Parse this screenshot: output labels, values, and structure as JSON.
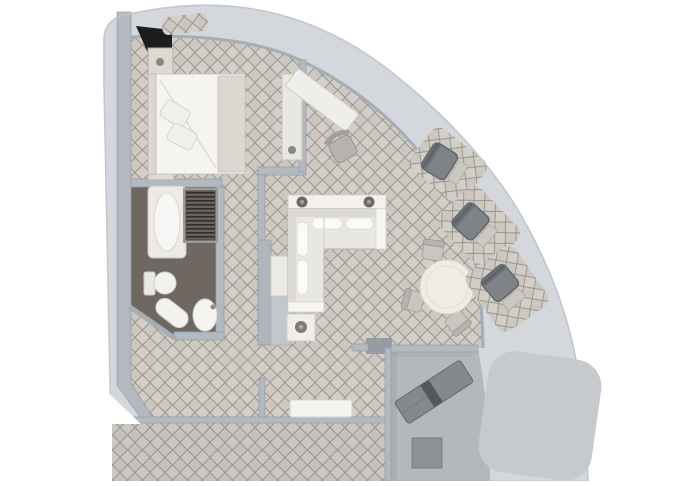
{
  "plan": {
    "title": "suite-floor-plan",
    "kind": "cruise-ship-suite-quarter-circle",
    "canvas": {
      "width": 680,
      "height": 486
    }
  },
  "colors": {
    "page_bg": "#ffffff",
    "hull_band": "#d4d8dd",
    "hull_edge": "#c2c7ce",
    "wall": "#b3b9c1",
    "wall_line": "#a2a9b2",
    "wall_light": "#c6cbd1",
    "carpet_base": "#ccc7c0",
    "carpet_line": "#8f8a82",
    "corridor_carpet_base": "#c5c2bd",
    "bathroom_floor": "#6f6761",
    "deck": "#b4b8bd",
    "deck_cutout": "#c6cacf",
    "furniture_white": "#f3f2ef",
    "furniture_shadow": "#cfccc6",
    "outdoor_dark": "#7f8388",
    "outdoor_darker": "#54575b",
    "knob_dark": "#6d6a66",
    "black_accent": "#1d1d1d",
    "closet_louver_dark": "#312f2d",
    "closet_louver_light": "#66625e",
    "chair_gray": "#b6b3ae",
    "table_top": "#efece4"
  },
  "rooms": [
    {
      "name": "bedroom"
    },
    {
      "name": "bathroom"
    },
    {
      "name": "wardrobe-closet"
    },
    {
      "name": "inner-corridor"
    },
    {
      "name": "living-room"
    },
    {
      "name": "dining-nook"
    },
    {
      "name": "private-balcony"
    },
    {
      "name": "curved-balcony-band"
    },
    {
      "name": "ship-corridor"
    }
  ],
  "furniture": {
    "bedroom": [
      "double-bed",
      "pillow",
      "pillow",
      "nightstand",
      "nightstand",
      "dresser",
      "desk",
      "desk-chair"
    ],
    "bathroom": [
      "bathtub",
      "toilet",
      "bidet",
      "sink",
      "louvered-closet"
    ],
    "living_room": [
      "l-shaped-sofa",
      "sofa-console",
      "side-table",
      "tv-bench",
      "cabinet"
    ],
    "dining_nook": [
      "round-table",
      "dining-chair",
      "dining-chair",
      "dining-chair"
    ],
    "private_balcony": [
      "sun-lounger",
      "balcony-table"
    ],
    "curved_balcony": [
      "deck-chair",
      "deck-chair",
      "deck-chair",
      "deck-pad"
    ]
  }
}
